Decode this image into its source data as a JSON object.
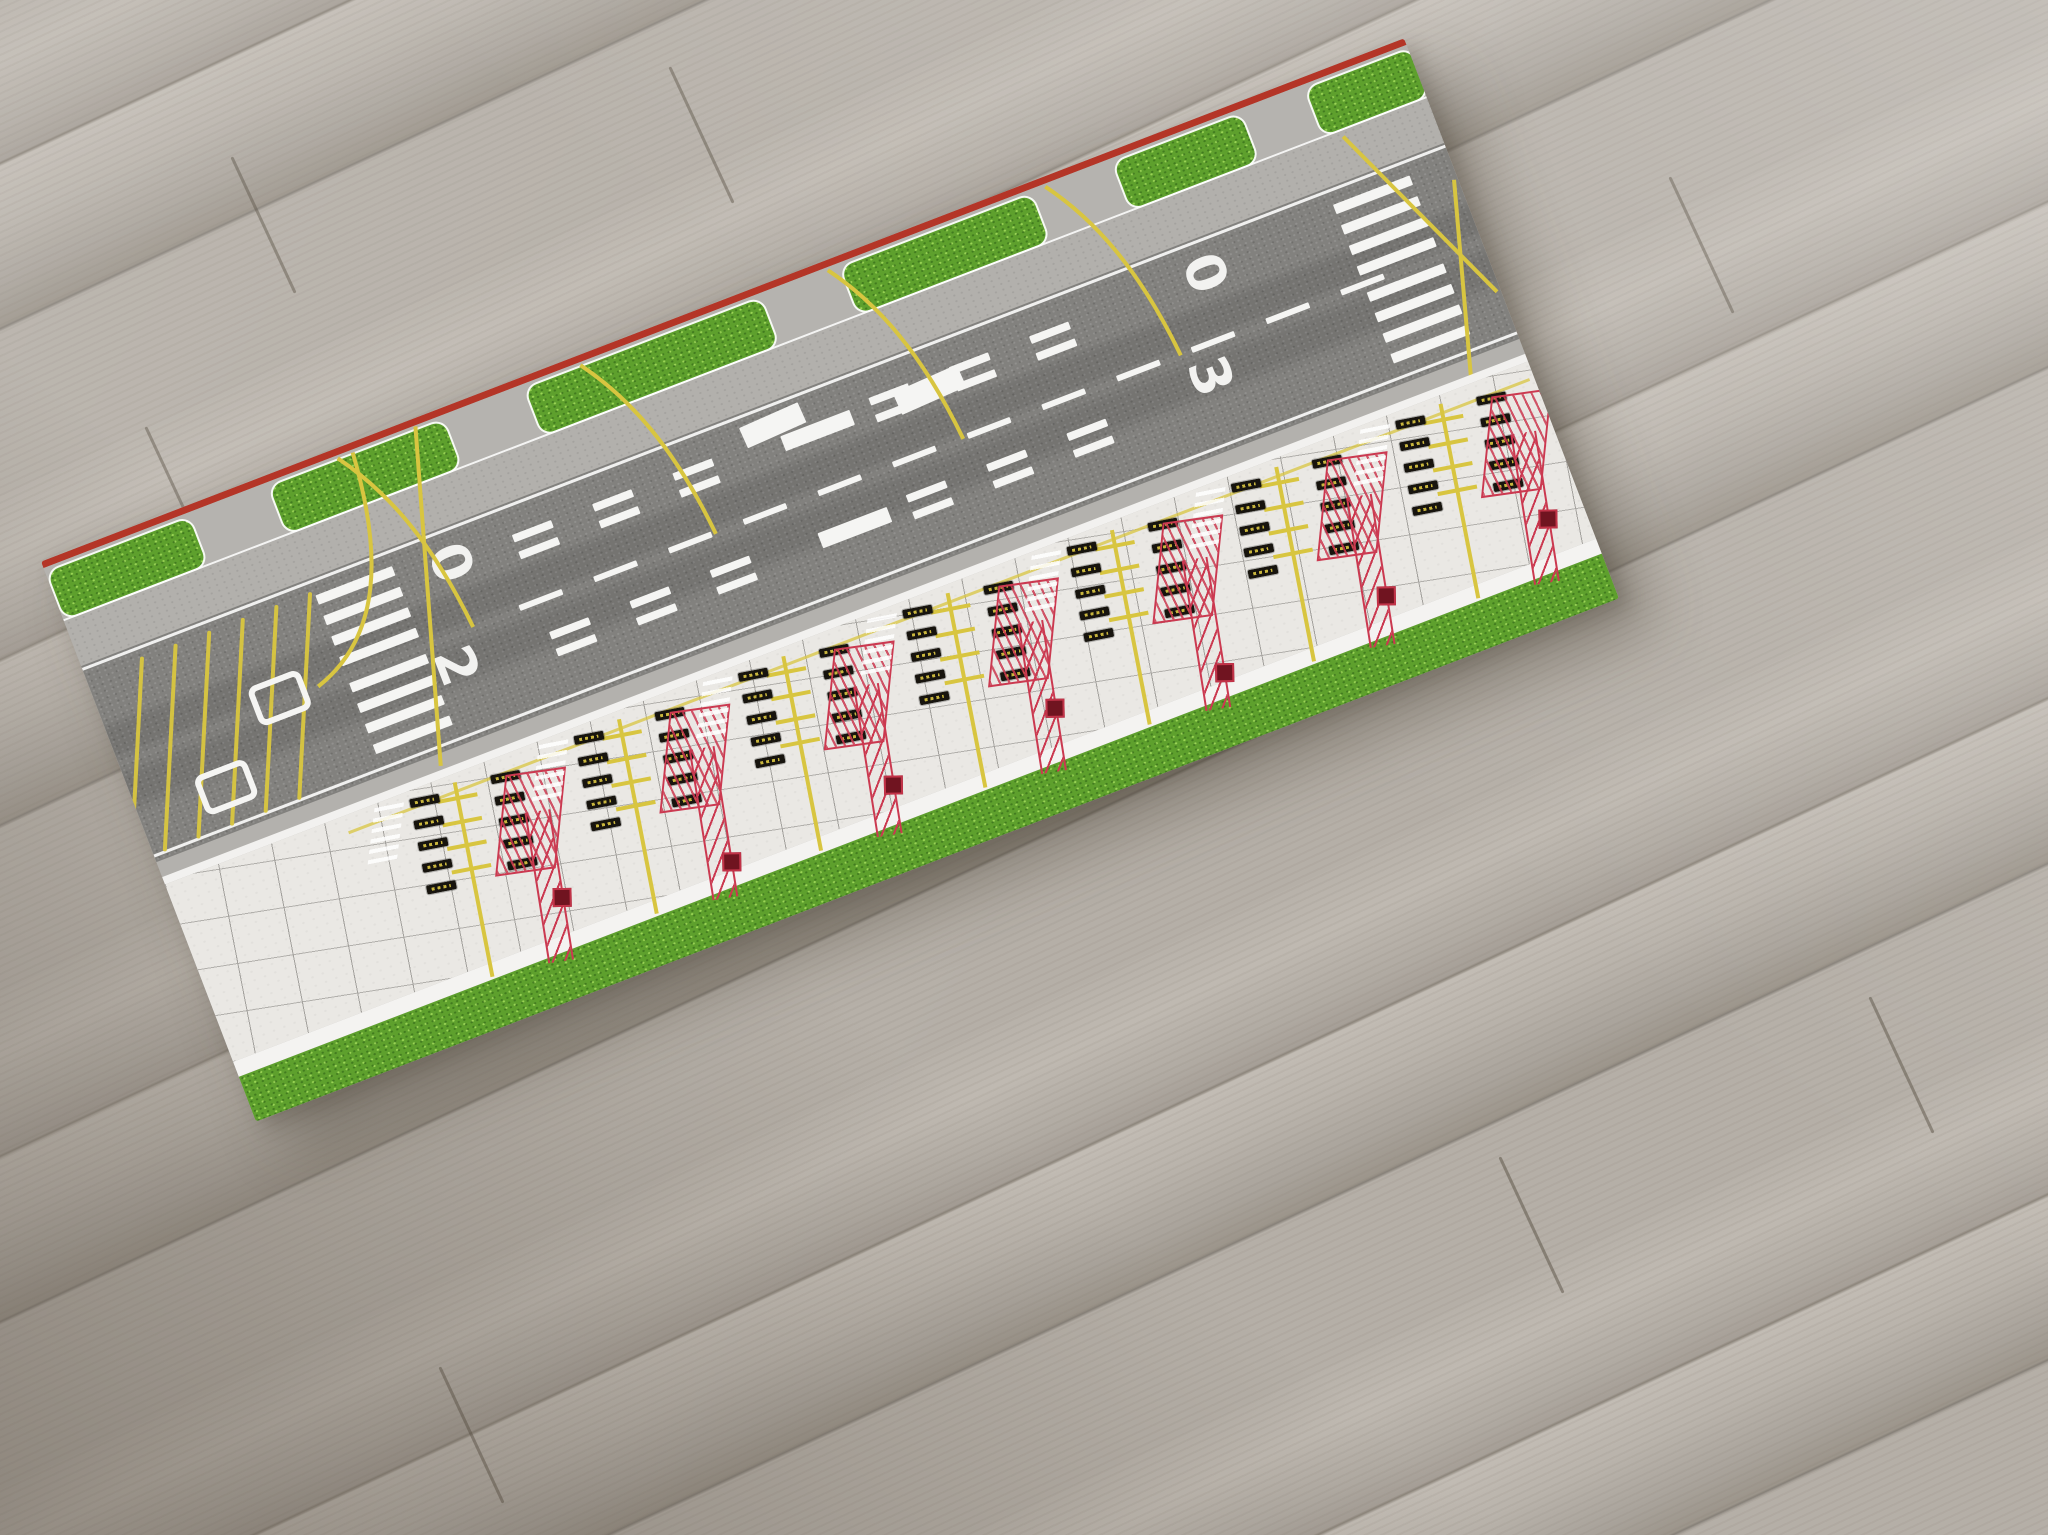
{
  "scene": {
    "description": "Model airport roll-up mat (runway with grass verges and gate apron) lying diagonally on a light grey wooden plank floor",
    "mat_rotation_deg": -21
  },
  "palette": {
    "floor": "#b5afa7",
    "floor_shadow": "#554c41",
    "trim_red": "#b43527",
    "grass": "#5ea02d",
    "runway_asphalt": "#82817e",
    "taxiway_grey": "#b2b0ac",
    "apron_concrete": "#eae8e4",
    "joint_grey": "#a3a19d",
    "marking_white": "#f5f5f3",
    "marking_yellow": "#d8c540",
    "marking_red": "#cb3950",
    "marker_dark_red": "#701420",
    "sign_black": "#17140e"
  },
  "floor": {
    "plank_angle_deg": -25,
    "seams": [
      [
        262,
        150
      ],
      [
        700,
        60
      ],
      [
        176,
        420
      ],
      [
        1530,
        1150
      ],
      [
        1900,
        990
      ],
      [
        470,
        1360
      ],
      [
        1700,
        170
      ]
    ]
  },
  "runway": {
    "left_designator": "20",
    "right_designator": "03",
    "left_digits": [
      "0",
      "2"
    ],
    "right_digits": [
      "0",
      "3"
    ],
    "designator_pos": {
      "left": [
        [
          352,
          118
        ],
        [
          320,
          216
        ]
      ],
      "right": [
        [
          1160,
          118
        ],
        [
          1128,
          216
        ]
      ]
    },
    "piano_bar_ys": [
      130,
      152,
      174,
      196,
      224,
      246,
      268,
      290
    ],
    "left_keys_x": 244,
    "right_keys_x": 1334,
    "key_w": 82,
    "key_h": 10,
    "centerline": {
      "y": 212,
      "x0": 430,
      "x1": 1320,
      "dash": 46,
      "gap": 34,
      "h": 6
    },
    "touchdown_x": [
      470,
      556,
      642,
      852,
      938,
      1024
    ],
    "touchdown_bar_ys": [
      144,
      162,
      248,
      266
    ],
    "aiming": {
      "x": 735,
      "w": 74,
      "h": 16,
      "ys": [
        148,
        252
      ]
    },
    "white_pads": [
      [
        700,
        124,
        64,
        22
      ],
      [
        856,
        146,
        70,
        24
      ]
    ]
  },
  "hold_bay": {
    "lines_x": [
      16,
      52,
      88,
      124,
      160,
      196
    ],
    "line_top": 116,
    "line_h": 208,
    "markers": [
      [
        146,
        192
      ],
      [
        64,
        256
      ]
    ]
  },
  "leadoff_paths": [
    "M 214 216 C 292 192 322 112 330 10",
    "M 380 216 C 372 120 348 58 314 10",
    "M 640 216 C 632 120 608 58 574 10",
    "M 905 216 C 897 120 873 58 839 10",
    "M 1138 216 C 1130 120 1106 58 1072 10",
    "M 300 334 L 398 8",
    "M 1400 344 L 1456 150",
    "M 1368 70 L 1456 270"
  ],
  "grass_top_patches": [
    [
      0,
      152
    ],
    [
      238,
      186
    ],
    [
      512,
      252
    ],
    [
      850,
      204
    ],
    [
      1142,
      136
    ],
    [
      1348,
      112
    ]
  ],
  "apron": {
    "gate_count": 7,
    "gates_x": [
      248,
      424,
      600,
      776,
      952,
      1128,
      1304
    ],
    "gate_lean_deg": 10,
    "stopbar_ys": [
      14,
      38,
      62,
      86
    ],
    "sign_columns": [
      {
        "x": 12,
        "ys": [
          8,
          30,
          52,
          74,
          96
        ]
      },
      {
        "x": 96,
        "ys": [
          0,
          22,
          44,
          66,
          88
        ]
      }
    ],
    "red_square_ys": [
      124,
      152,
      138,
      124,
      152,
      138,
      124
    ]
  }
}
